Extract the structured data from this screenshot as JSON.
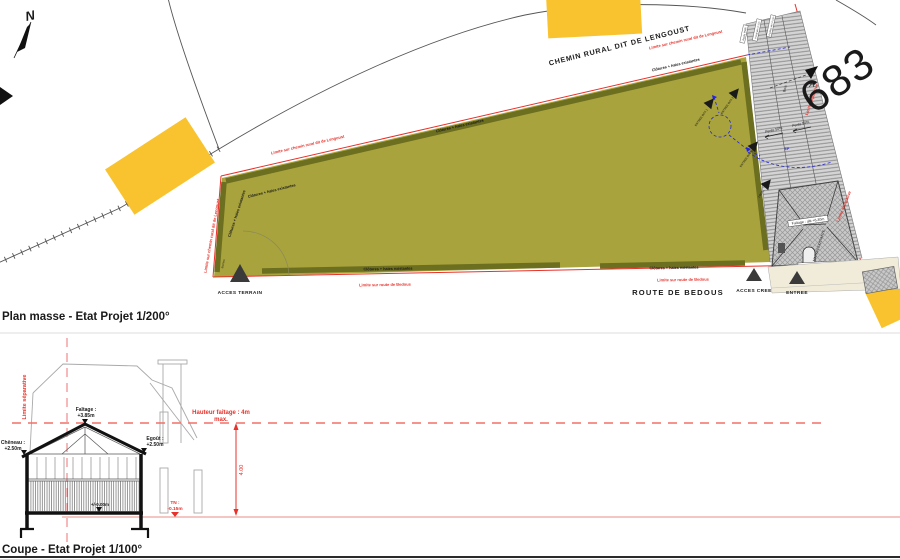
{
  "plan": {
    "title": "Plan masse - Etat Projet 1/200°",
    "labels": {
      "chemin": "CHEMIN RURAL DIT DE LENGOUST",
      "route": "ROUTE DE BEDOUS",
      "parcel": "683",
      "north": "N",
      "marker_a": "A",
      "acces_terrain": "ACCES TERRAIN",
      "acces_cree": "ACCES CREE",
      "entree": "ENTREE",
      "clotures": "Clôtures + haies existantes",
      "limite_chemin": "Limite sur chemin rural dit de Lengoust",
      "limite_route": "Limite sur route de Bedous",
      "limite_separative": "Limite séparative",
      "maison": "MAISON EXISTANTE",
      "faitage_alti": "Faîtage : alti +6.30m",
      "egout_alti": "Egoût : alti +3.28m",
      "pente": "Pente 50%",
      "bois": "Bois",
      "ep": "EP",
      "box1": "ENTREE BOX 1",
      "box2": "ENTREE BOX 2",
      "box3": "ENTREE BOX 3",
      "local": "LOCAL",
      "barriere": "Barrière",
      "acces_pmr": "Accès PMR",
      "portail": "Portail alti +2.10m",
      "portillon": "Portillon alti +2.10m"
    }
  },
  "coupe": {
    "title": "Coupe - Etat Projet 1/100°",
    "faitage_l1": "Faîtage :",
    "faitage_l2": "+3.85m",
    "cheneau_l1": "Chêneau :",
    "cheneau_l2": "+2.50m",
    "egout_l1": "Egoût :",
    "egout_l2": "+2.50m",
    "niveau": "+/-0.00m",
    "tn_l1": "TN :",
    "tn_l2": "-0.15m",
    "hauteur_l1": "Hauteur faîtage : 4m",
    "hauteur_l2": "max.",
    "dim_400": "4.00",
    "limite_separative": "Limite séparative"
  },
  "colors": {
    "terrain_green": "#a8a33c",
    "hedge_olive": "#6c6e20",
    "building_yellow": "#f9c32f",
    "limite_red": "#e8312a",
    "network_blue": "#2424e0",
    "max_height_dash": "#f2706a",
    "ground_line": "#eda49c",
    "hatch_gray": "#d4d4d4"
  }
}
